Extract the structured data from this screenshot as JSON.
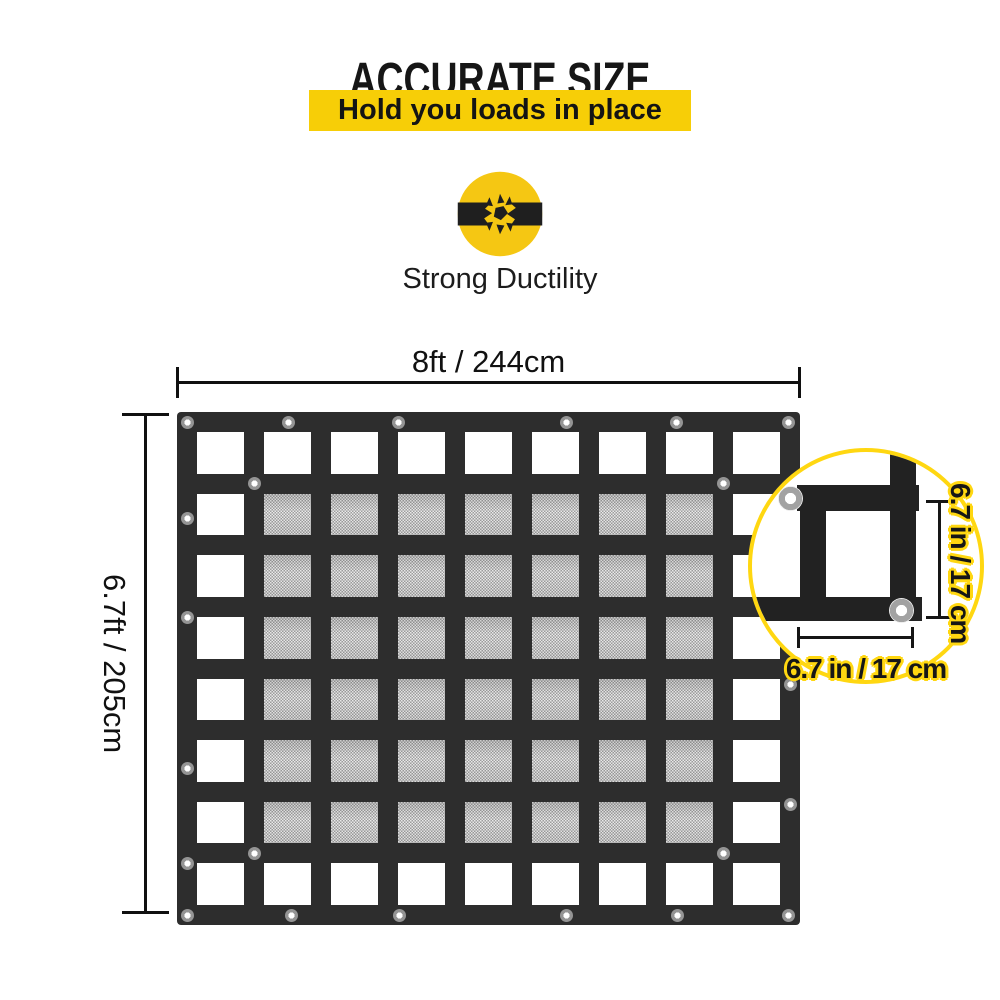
{
  "header": {
    "title": "ACCURATE SIZE",
    "subtitle": "Hold you loads in place"
  },
  "feature": {
    "icon": "breaking-strap-icon",
    "label": "Strong Ductility"
  },
  "diagram": {
    "width_label": "8ft / 244cm",
    "height_label": "6.7ft / 205cm",
    "net": {
      "columns": 9,
      "rows": 8,
      "mesh_col_start": 2,
      "mesh_col_end": 8,
      "mesh_row_start": 2,
      "mesh_row_end": 7
    }
  },
  "detail": {
    "vertical_label": "6.7 in / 17 cm",
    "horizontal_label": "6.7 in / 17 cm"
  },
  "colors": {
    "banner_yellow": "#F7CE07",
    "icon_yellow": "#F5C713",
    "accent_yellow": "#FFD711",
    "webbing_black": "#2D2D2D",
    "text_black": "#161616"
  }
}
